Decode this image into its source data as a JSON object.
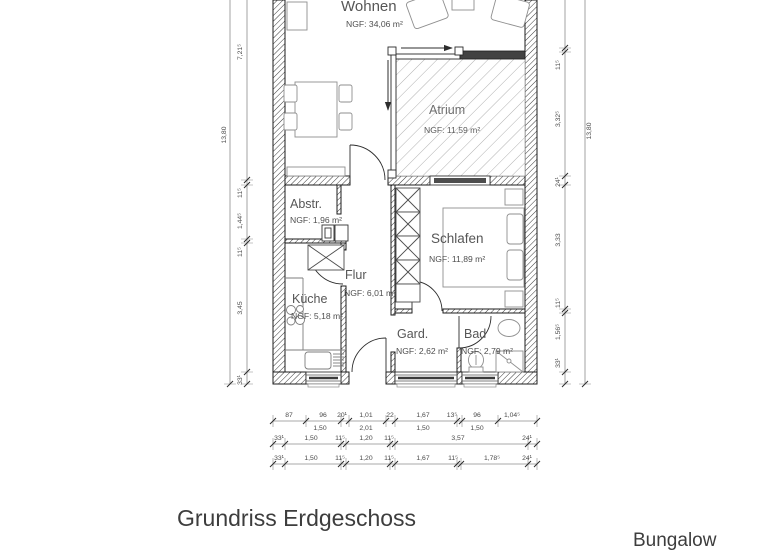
{
  "title": "Grundriss Erdgeschoss",
  "subtitle": "Bungalow",
  "rooms": {
    "wohnen": {
      "name": "Wohnen",
      "area": "NGF: 34,06 m²"
    },
    "atrium": {
      "name": "Atrium",
      "area": "NGF: 11,59 m²"
    },
    "abstellraum": {
      "name": "Abstr.",
      "area": "NGF: 1,96 m²"
    },
    "schlafen": {
      "name": "Schlafen",
      "area": "NGF: 11,89 m²"
    },
    "flur": {
      "name": "Flur",
      "area": "NGF: 6,01 m²"
    },
    "kueche": {
      "name": "Küche",
      "area": "NGF: 5,18 m²"
    },
    "garderobe": {
      "name": "Gard.",
      "area": "NGF: 2,62 m²"
    },
    "bad": {
      "name": "Bad",
      "area": "NGF: 2,79 m²"
    }
  },
  "dimensions": {
    "left_total": "13,80",
    "right_total": "13,80",
    "left_chain": [
      "7,21⁵",
      "11⁵",
      "1,44⁵",
      "11⁵",
      "3,45",
      "33¹"
    ],
    "right_chain": [
      "11⁵",
      "3,32⁵",
      "24¹",
      "3,33",
      "11⁵",
      "1,56⁵",
      "33¹"
    ],
    "bottom_row1_above": [
      "87",
      "96",
      "20¹",
      "1,01",
      "22",
      "1,67",
      "13⁵",
      "96",
      "1,04⁵"
    ],
    "bottom_row1_below": [
      "1,50",
      "2,01",
      "1,50",
      "1,50"
    ],
    "bottom_row2": [
      "33¹",
      "1,50",
      "11⁵",
      "1,20",
      "11⁵",
      "3,57",
      "24¹"
    ],
    "bottom_row3": [
      "33¹",
      "1,50",
      "11⁵",
      "1,20",
      "11⁵",
      "1,67",
      "11⁵",
      "1,78⁵",
      "24¹"
    ]
  },
  "colors": {
    "wall_line": "#1e1e1e",
    "hatch": "#3a3a3a",
    "atrium_hatch": "#9c9c9c",
    "furniture": "#8f8f8f",
    "dim_text": "#4a4a4a",
    "title_text": "#3d3d3d"
  }
}
